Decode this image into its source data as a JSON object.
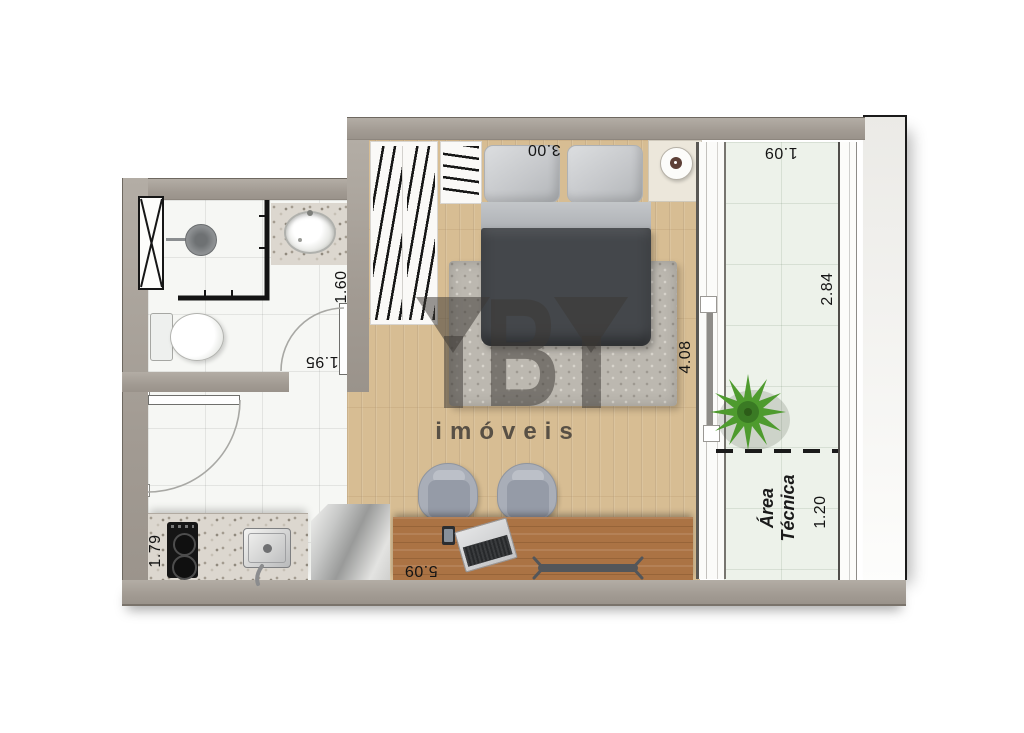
{
  "watermark": {
    "brand": "YBY",
    "tagline": "imóveis"
  },
  "rooms": {
    "bedroom": {
      "width": "3.00",
      "length": "4.08"
    },
    "studio": {
      "length": "5.09"
    },
    "bathroom": {
      "width": "1.95",
      "depth": "1.60"
    },
    "kitchen": {
      "depth": "1.79"
    },
    "balcony": {
      "width": "1.09",
      "length": "2.84"
    },
    "technical_area": {
      "label_line1": "Área",
      "label_line2": "Técnica",
      "depth": "1.20"
    }
  },
  "colors": {
    "wall": "#a59e96",
    "wood_floor": "#d7bd93",
    "desk_wood": "#ab7344",
    "tile": "#f6f7f4",
    "balcony_tile": "#edf2ea",
    "bed_duvet": "#44474b",
    "plant_green": "#4e9b2e",
    "dimension_text": "#141414"
  }
}
